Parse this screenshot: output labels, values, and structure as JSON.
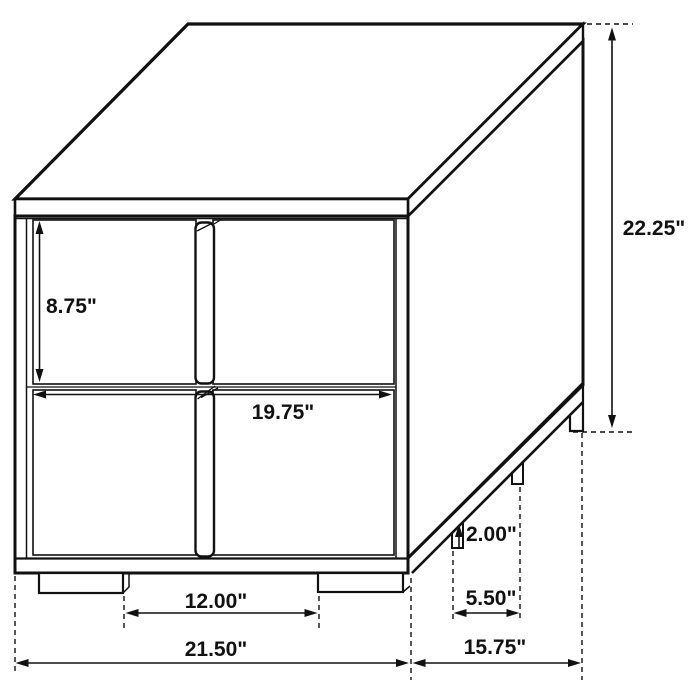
{
  "drawing": {
    "title": "Two-drawer nightstand dimensional diagram",
    "unit": "inches",
    "line_color": "#111111",
    "background_color": "#ffffff",
    "dimensions": {
      "drawer_front_height": "8.75\"",
      "drawer_front_width": "19.75\"",
      "overall_height": "22.25\"",
      "leg_height": "2.00\"",
      "side_leg_spacing": "5.50\"",
      "front_leg_spacing": "12.00\"",
      "overall_width": "21.50\"",
      "overall_depth": "15.75\""
    },
    "dimension_values": {
      "drawer_front_height_in": 8.75,
      "drawer_front_width_in": 19.75,
      "overall_height_in": 22.25,
      "leg_height_in": 2.0,
      "side_leg_spacing_in": 5.5,
      "front_leg_spacing_in": 12.0,
      "overall_width_in": 21.5,
      "overall_depth_in": 15.75
    }
  }
}
